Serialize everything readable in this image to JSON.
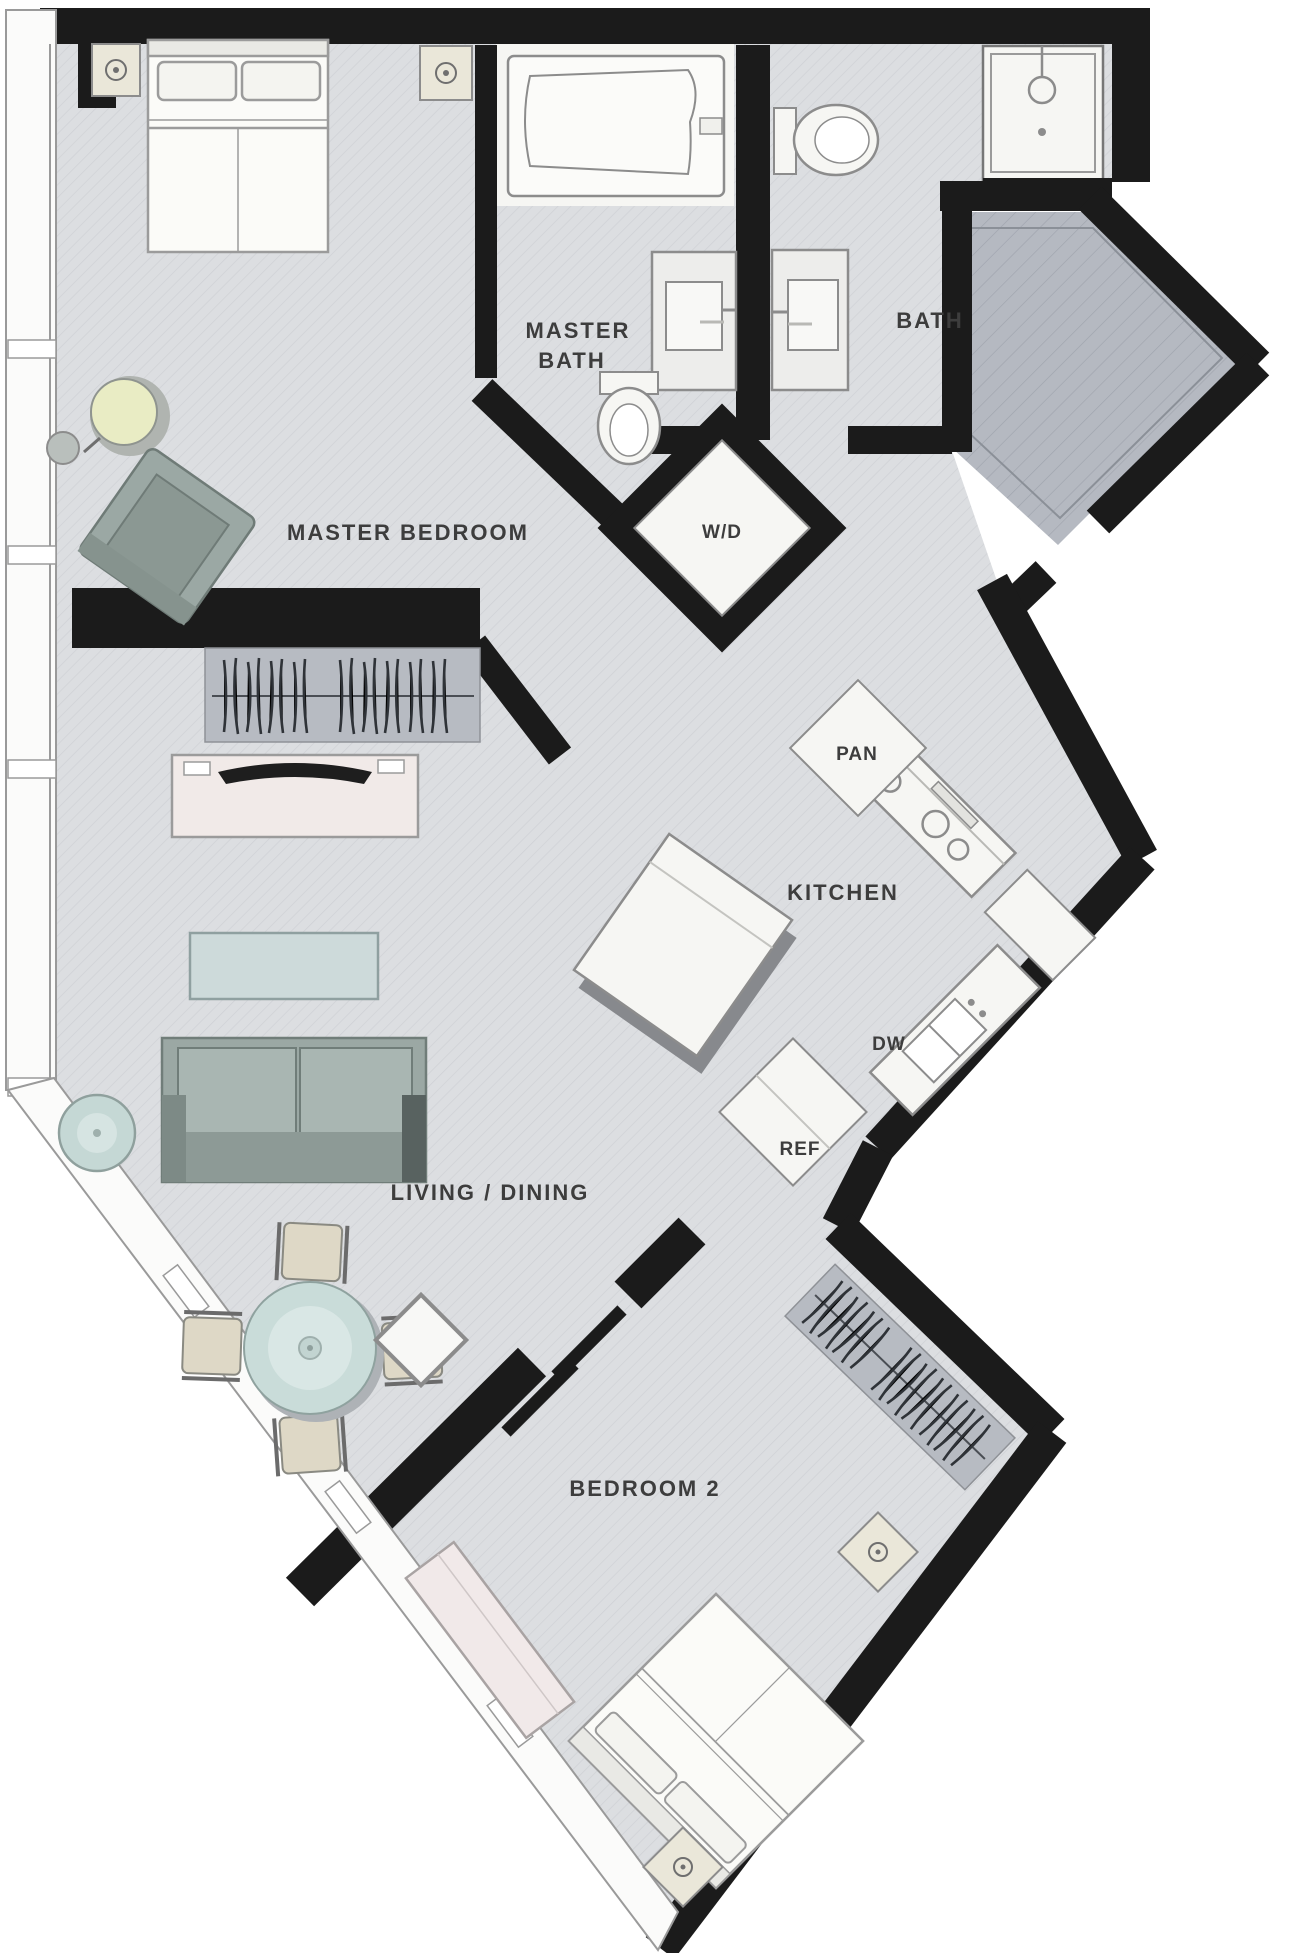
{
  "title": "Two-bedroom apartment floor plan",
  "colors": {
    "wall": "#1b1b1b",
    "floor": "#dcdee1",
    "floorWhite": "#f6f6f3",
    "balcony": "#b5b9c1",
    "closet": "#b7bbc2",
    "text": "#3d3d3d",
    "sofa": "#9ba8a4",
    "teal": "#c9dcd9",
    "lamp": "#e9ecc4"
  },
  "rooms": {
    "master_bedroom": {
      "label": "MASTER BEDROOM"
    },
    "master_bath": {
      "label": "MASTER BATH",
      "line1": "MASTER",
      "line2": "BATH"
    },
    "bath": {
      "label": "BATH"
    },
    "washer_dryer": {
      "label": "W/D"
    },
    "pantry": {
      "label": "PAN"
    },
    "kitchen": {
      "label": "KITCHEN"
    },
    "dishwasher": {
      "label": "DW"
    },
    "refrigerator": {
      "label": "REF"
    },
    "living_dining": {
      "label": "LIVING / DINING"
    },
    "bedroom_2": {
      "label": "BEDROOM 2"
    }
  },
  "furniture": [
    "king-bed",
    "nightstand-left",
    "nightstand-right",
    "round-lamp-table",
    "stool",
    "armchair",
    "master-closet-hangers",
    "media-console-tv",
    "coffee-table",
    "sofa",
    "side-table",
    "dining-table-round",
    "dining-chairs-4",
    "kitchen-island",
    "range-cooktop",
    "kitchen-sink",
    "pantry-cabinet",
    "refrigerator-box",
    "bathtub",
    "master-vanity-sink",
    "master-toilet",
    "bath-toilet",
    "bath-vanity-sink",
    "shower-stall",
    "washer-dryer-unit",
    "bedroom2-bed",
    "bedroom2-nightstands",
    "bedroom2-dresser",
    "bedroom2-closet-hangers",
    "bedroom2-cabinet",
    "balcony-terrace"
  ]
}
